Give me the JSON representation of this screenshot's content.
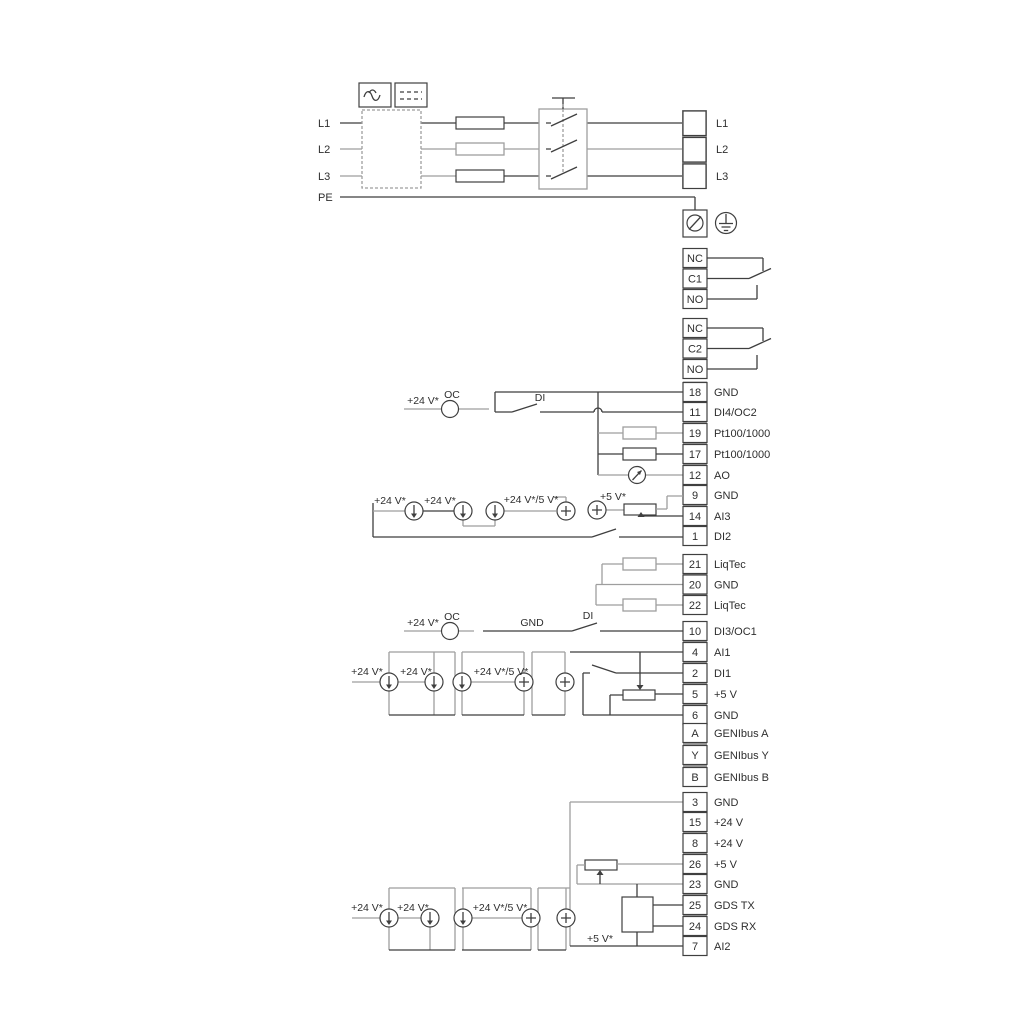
{
  "title": "frequency-converter-wiring-diagram",
  "colors": {
    "wire_dark": "#3f3f3f",
    "wire_light": "#9e9e9e",
    "terminal_separator": "#9c9c9c",
    "text": "#2e2e2e",
    "background": "#ffffff"
  },
  "power_in": {
    "l1": "L1",
    "l2": "L2",
    "l3": "L3",
    "pe": "PE"
  },
  "power_out": {
    "l1": "L1",
    "l2": "L2",
    "l3": "L3"
  },
  "relay1": {
    "terminals": [
      {
        "n": "NC"
      },
      {
        "n": "C1"
      },
      {
        "n": "NO"
      }
    ]
  },
  "relay2": {
    "terminals": [
      {
        "n": "NC"
      },
      {
        "n": "C2"
      },
      {
        "n": "NO"
      }
    ]
  },
  "io18": {
    "terminals": [
      {
        "n": "18",
        "label": "GND"
      },
      {
        "n": "11",
        "label": "DI4/OC2"
      },
      {
        "n": "19",
        "label": "Pt100/1000"
      },
      {
        "n": "17",
        "label": "Pt100/1000"
      },
      {
        "n": "12",
        "label": "AO"
      },
      {
        "n": "9",
        "label": "GND"
      },
      {
        "n": "14",
        "label": "AI3"
      },
      {
        "n": "1",
        "label": "DI2"
      }
    ]
  },
  "liqtec": {
    "terminals": [
      {
        "n": "21",
        "label": "LiqTec"
      },
      {
        "n": "20",
        "label": "GND"
      },
      {
        "n": "22",
        "label": "LiqTec"
      }
    ]
  },
  "io10": {
    "terminals": [
      {
        "n": "10",
        "label": "DI3/OC1"
      },
      {
        "n": "4",
        "label": "AI1"
      },
      {
        "n": "2",
        "label": "DI1"
      },
      {
        "n": "5",
        "label": "+5 V"
      },
      {
        "n": "6",
        "label": "GND"
      }
    ]
  },
  "genibus": {
    "terminals": [
      {
        "n": "A",
        "label": "GENIbus A"
      },
      {
        "n": "Y",
        "label": "GENIbus Y"
      },
      {
        "n": "B",
        "label": "GENIbus B"
      }
    ]
  },
  "io3": {
    "terminals": [
      {
        "n": "3",
        "label": "GND"
      },
      {
        "n": "15",
        "label": "+24 V"
      },
      {
        "n": "8",
        "label": "+24 V"
      },
      {
        "n": "26",
        "label": "+5 V"
      },
      {
        "n": "23",
        "label": "GND"
      },
      {
        "n": "25",
        "label": "GDS TX"
      },
      {
        "n": "24",
        "label": "GDS RX"
      },
      {
        "n": "7",
        "label": "AI2"
      }
    ]
  },
  "labels": {
    "v24": "+24 V*",
    "v24_5": "+24 V*/5 V*",
    "v5": "+5 V*",
    "oc": "OC",
    "di": "DI",
    "gnd": "GND"
  }
}
